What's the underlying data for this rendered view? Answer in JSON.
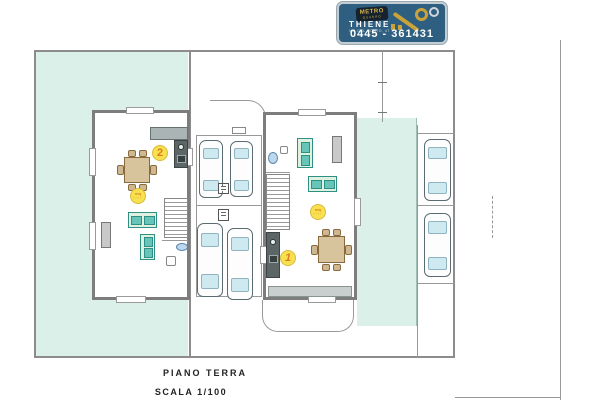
{
  "logo": {
    "brand": "METRO",
    "brand_sub": "QUADRO",
    "city": "THIENE",
    "address_line": "VIA DEL COSTO, 47",
    "phone": "0445 - 361431"
  },
  "plan": {
    "title": "PIANO TERRA",
    "scale": "SCALA 1/100"
  },
  "units": [
    {
      "number": "2",
      "area_label": "mq",
      "area_value": "····"
    },
    {
      "number": "1",
      "area_label": "mq",
      "area_value": "····"
    }
  ],
  "colors": {
    "garden": "#daf0e8",
    "wall_gray": "#7d7d7d",
    "logo_background": "#2f5f80",
    "key_gold": "#c9a23a",
    "highlight_yellow": "#f7e14e",
    "number_orange": "#e07b1f",
    "sofa_teal": "#66c4b8",
    "car_window_blue": "#cfe9f0"
  }
}
